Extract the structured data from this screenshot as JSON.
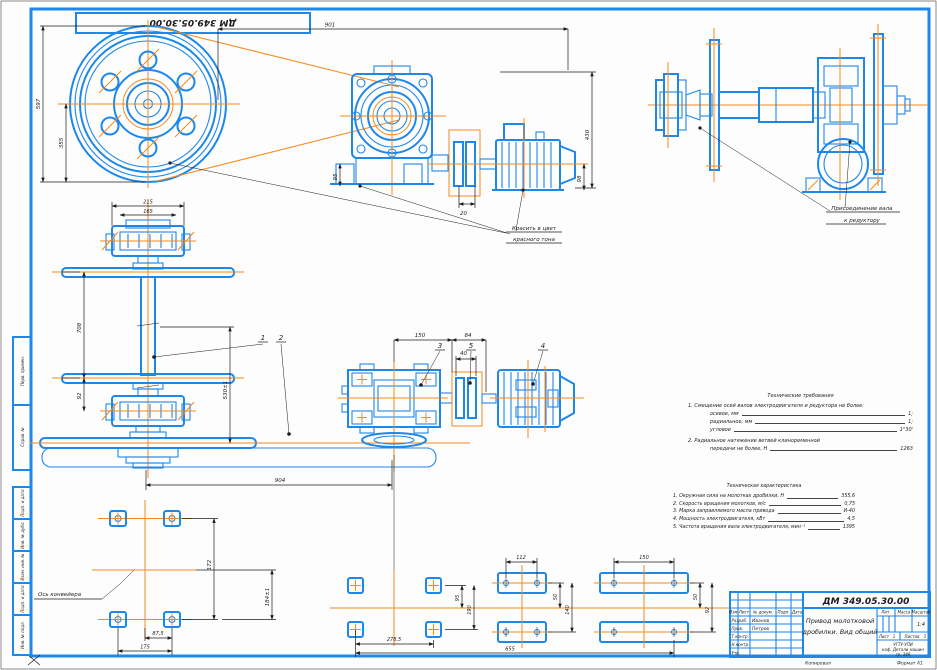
{
  "page": {
    "copied_label": "Копировал",
    "format_note": "Формат А1"
  },
  "stamp": {
    "designation": "ДМ 349.05.30.00"
  },
  "frame": {
    "side_labels": [
      "Перв. примен.",
      "Справ. №",
      "Подп. и дата",
      "Инв. № дубл.",
      "Взам. инв. №",
      "Подп. и дата",
      "Инв. № подл."
    ]
  },
  "dims": {
    "pulley_od": "597",
    "pulley_pcd": "355",
    "overall_w": "901",
    "overall_h": "430",
    "gbx_foot": "95",
    "motor_foot": "98",
    "coupling_gap": "20",
    "bearing_w": "215",
    "bearing_inner": "165",
    "disc_span": "708",
    "disc_to_bearing": "92",
    "axes_offset": "530±1",
    "center_distance": "904",
    "tv_a": "150",
    "tv_b": "84",
    "tv_c": "40",
    "p1_rows": "172",
    "p1_axis": "184±1",
    "p1_half": "87,5",
    "p1_cols": "175",
    "p2_cols": "278,5",
    "p2_total": "655",
    "p2_half": "95",
    "p2_rows": "190",
    "m_holes": "112",
    "m_half": "50",
    "m_rows": "140",
    "p3_holes": "150",
    "p3_half": "50",
    "p3_rows": "92"
  },
  "balloons": {
    "b1": "1",
    "b2": "2",
    "b3": "3",
    "b4": "4",
    "b5": "5"
  },
  "notes": {
    "paint_l1": "Красить в цвет",
    "paint_l2": "красного тона",
    "shaft_l1": "Присоединение вала",
    "shaft_l2": "к редуктору",
    "axis_label": "Ось конвейера"
  },
  "tech_req": {
    "title": "Технические требования",
    "p1": "1. Смещение осей валов электродвигателя и редуктора не более:",
    "items": [
      [
        "осевое, мм",
        "1;"
      ],
      [
        "радиальное, мм",
        "1;"
      ],
      [
        "угловое",
        "1°30'"
      ]
    ],
    "p2": "2. Радиальное натяжение ветвей клиноременной",
    "p2b": "передачи не более, Н",
    "p2v": "1263"
  },
  "tech_char": {
    "title": "Техническая характеристика",
    "items": [
      [
        "1. Окружная сила на молотках дробилки, Н",
        "355,6"
      ],
      [
        "2. Скорость вращения молотков, м/с",
        "0,75"
      ],
      [
        "3. Марка заправляемого масла привода",
        "И-40"
      ],
      [
        "4. Мощность электродвигателя, кВт",
        "4,5"
      ],
      [
        "5. Частота вращения вала электродвигателя, мин⁻¹",
        "1395"
      ]
    ]
  },
  "title_block": {
    "designation": "ДМ 349.05.30.00",
    "name_l1": "Привод молотковой",
    "name_l2": "дробилки. Вид общий",
    "hdr": [
      "Изм.",
      "Лист",
      "№ докум.",
      "Подп.",
      "Дата"
    ],
    "rows": [
      "Разраб.",
      "Пров.",
      "Т.контр.",
      "Н.контр.",
      "Утв."
    ],
    "names": [
      "Иванов",
      "Петров"
    ],
    "lit": "Лит.",
    "mass": "Масса",
    "scale_lbl": "Масштаб",
    "scale": "1:4",
    "sheet_lbl": "Лист",
    "sheet": "1",
    "sheets_lbl": "Листов",
    "sheets": "1",
    "org": [
      "УГТУ-УПИ",
      "каф. Детали машин",
      "гр. 349"
    ]
  }
}
